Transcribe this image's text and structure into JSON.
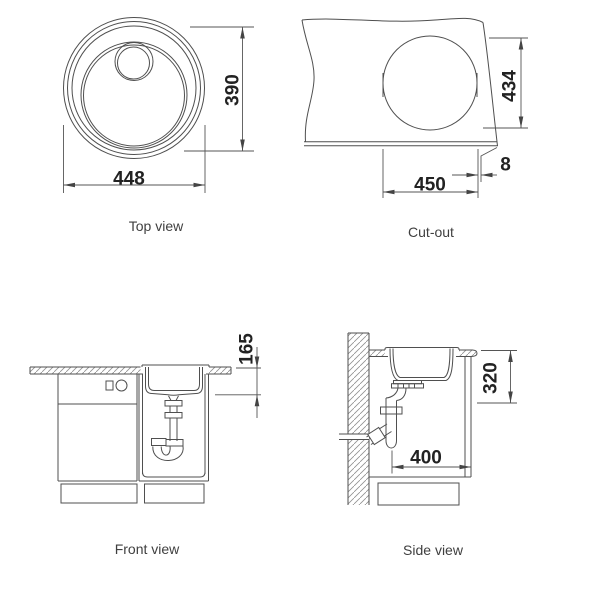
{
  "drawing": {
    "views": {
      "top": {
        "label": "Top view",
        "width_mm": "448",
        "height_mm": "390"
      },
      "cutout": {
        "label": "Cut-out",
        "width_mm": "450",
        "height_mm": "434",
        "edge_mm": "8"
      },
      "front": {
        "label": "Front view",
        "bowl_depth_mm": "165"
      },
      "side": {
        "label": "Side view",
        "drain_offset_mm": "400",
        "clearance_mm": "320"
      }
    },
    "colors": {
      "background": "#ffffff",
      "object_line": "#4f4f4f",
      "dimension_line": "#555555",
      "hatch_line": "#909090",
      "dimension_text": "#222222",
      "label_text": "#3f3f3f"
    }
  }
}
